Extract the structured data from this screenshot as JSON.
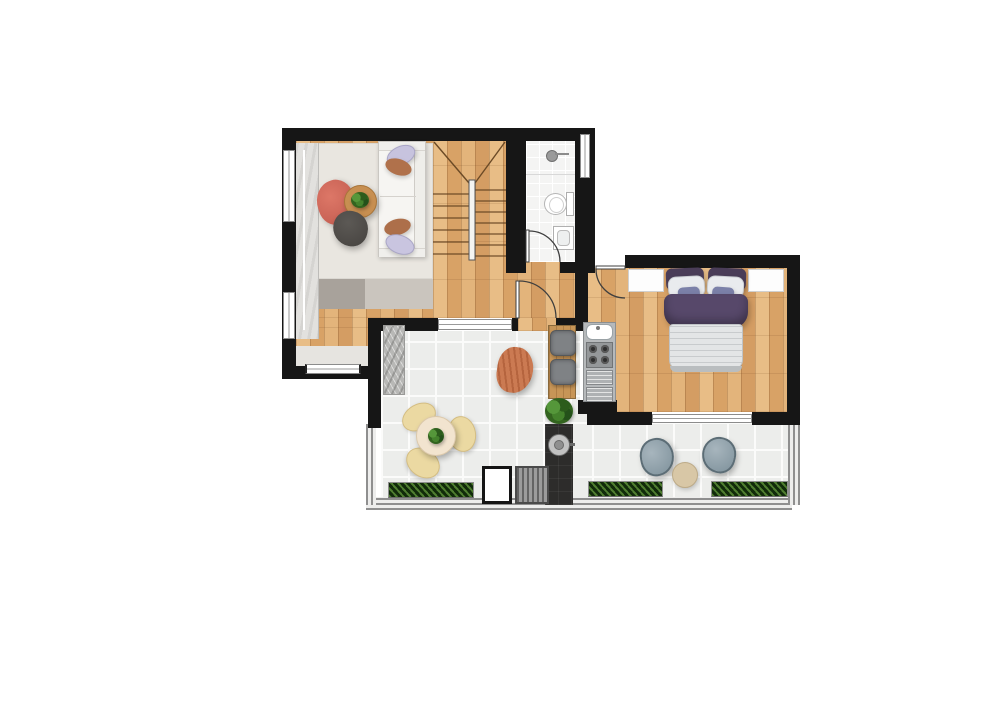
{
  "title": "",
  "visible_text": [],
  "colors": {
    "wall": "#161616",
    "wood-main": "#dfad75",
    "tile-floor": "#ecedeb",
    "rug-light": "#e9e6e0",
    "rug-dark": "#a8a29b",
    "bed-duvet": "#57486a",
    "accent-pillow": "#7b80a8",
    "lavender-pillow": "#c7c3de",
    "terracotta-pillow": "#b0714b",
    "coral-table": "#d4695c",
    "ochre-table": "#c78f51",
    "charcoal-table": "#504d4a",
    "cream-chair": "#ebd9a2",
    "pouf-orange": "#cb7a52",
    "planter-green": "#1d3b16",
    "steel-counter": "#b6b9bb",
    "grill-column": "#2d2c2b",
    "balcony-chair": "#8fa0aa",
    "railing-gray": "#8f8f8f"
  },
  "scene": {
    "type": "apartment-floor-plan-top-view",
    "rooms": [
      {
        "name": "living-room",
        "items": [
          "sofa",
          "lavender-pillows",
          "terracotta-pillows",
          "coral-side-table",
          "ochre-side-table-with-plant",
          "charcoal-side-table",
          "area-rug",
          "curtain-panel",
          "two-left-wall-windows",
          "bottom-window"
        ]
      },
      {
        "name": "staircase-hall",
        "items": [
          "u-shaped-staircase",
          "center-railing",
          "wood-floor",
          "terrace-door",
          "bedroom-door"
        ]
      },
      {
        "name": "bathroom",
        "items": [
          "shower-head",
          "toilet",
          "sink",
          "side-window",
          "door-swing"
        ]
      },
      {
        "name": "bedroom",
        "items": [
          "double-bed-purple-duvet",
          "white-pillows",
          "accent-pillows",
          "nightstand-left",
          "nightstand-right",
          "balcony-window"
        ]
      },
      {
        "name": "gourmet-terrace",
        "items": [
          "kitchen-counter-sink",
          "cooktop-four-burners",
          "utensil-drawers",
          "wood-bar-counter",
          "two-bar-stools",
          "potted-plant",
          "round-dining-table-with-plant",
          "three-cream-chairs",
          "orange-pouf",
          "vertical-garden-panel",
          "grill-column",
          "round-barbecue",
          "floor-hatch",
          "drain-grate",
          "three-green-planters",
          "two-lounge-chairs",
          "round-side-table",
          "glass-railing"
        ]
      }
    ]
  }
}
